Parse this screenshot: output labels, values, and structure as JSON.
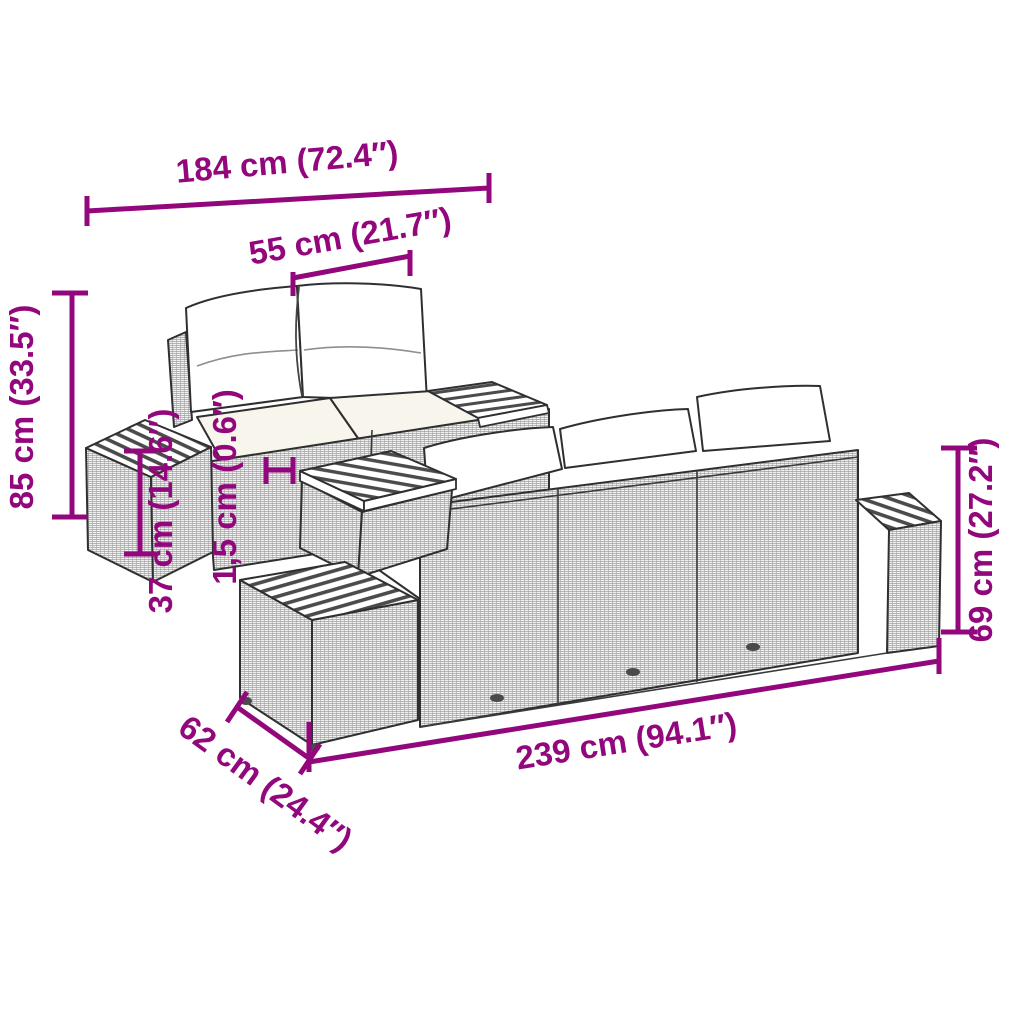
{
  "image": {
    "type": "product-dimension-diagram",
    "subject": "poly rattan garden lounge furniture set line drawing",
    "background_color": "#ffffff",
    "accent_color": "#93077D"
  },
  "dimensions": {
    "overall_width": "184 cm (72.4″)",
    "seat_cushion_width": "55 cm (21.7″)",
    "overall_height": "85 cm (33.5″)",
    "side_table_height": "37 cm (14.6″)",
    "tabletop_thickness": "1,5 cm (0.6″)",
    "bench_height": "69 cm (27.2″)",
    "bench_length": "239 cm (94.1″)",
    "bench_depth": "62 cm (24.4″)"
  }
}
